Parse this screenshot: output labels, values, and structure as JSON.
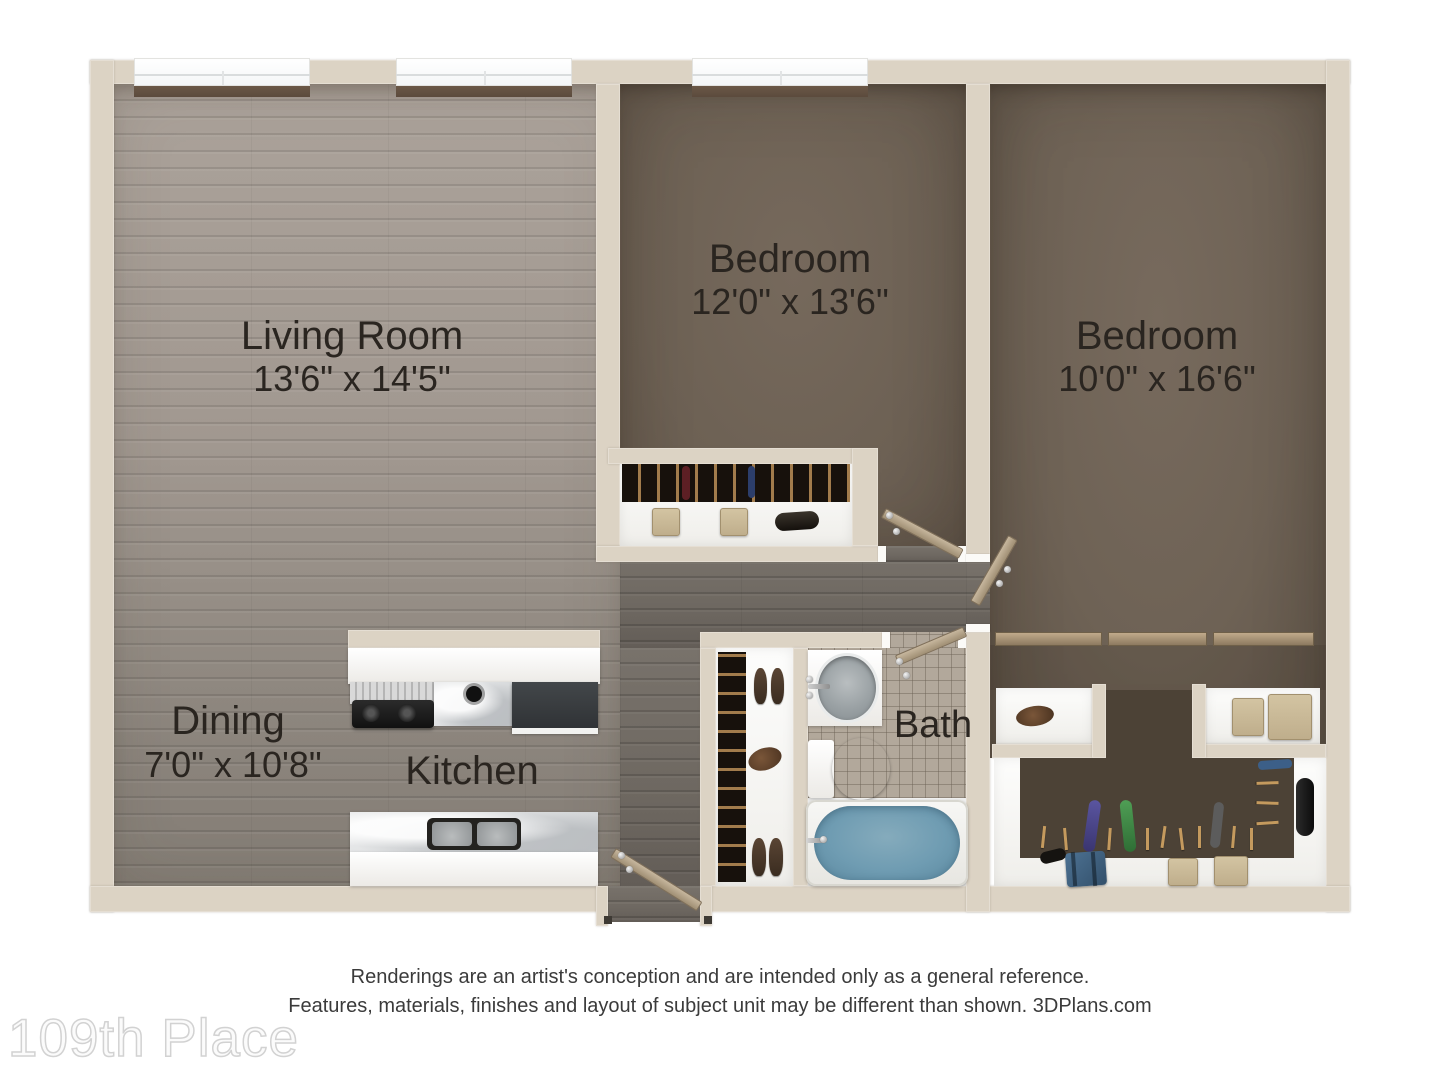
{
  "rooms": {
    "living": {
      "name": "Living Room",
      "dims": "13'6\" x 14'5\""
    },
    "bedroom1": {
      "name": "Bedroom",
      "dims": "12'0\" x 13'6\""
    },
    "bedroom2": {
      "name": "Bedroom",
      "dims": "10'0\" x 16'6\""
    },
    "dining": {
      "name": "Dining",
      "dims": "7'0\" x 10'8\""
    },
    "kitchen": {
      "name": "Kitchen"
    },
    "bath": {
      "name": "Bath"
    }
  },
  "disclaimer": {
    "line1": "Renderings are an artist's conception and are intended only as a general reference.",
    "line2": "Features, materials, finishes and layout of subject unit may be different than shown. 3DPlans.com"
  },
  "watermark": "109th Place",
  "colors": {
    "wall": "#dcd3c4",
    "living_floor": "#a19890",
    "hall_floor": "#6e6861",
    "bedroom_carpet": "#6d6154",
    "bath_tile": "#b2a89b",
    "tub_water": "#6f9cb2",
    "window_sill": "#5d4c3e"
  }
}
